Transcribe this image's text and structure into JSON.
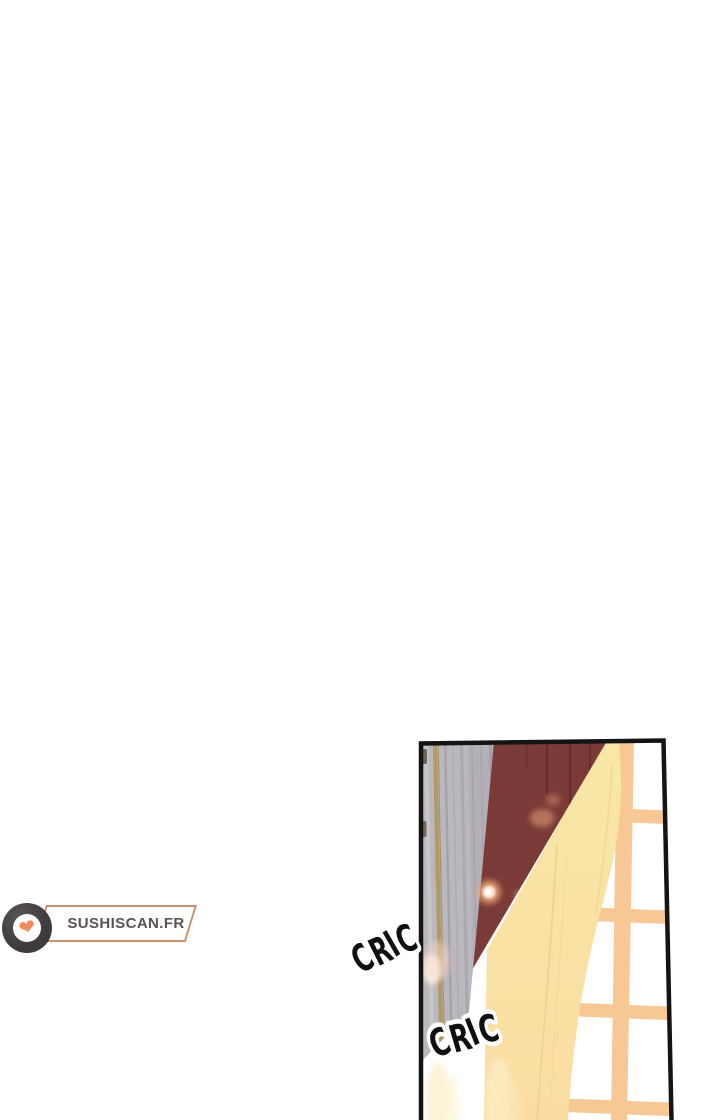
{
  "page": {
    "background_color": "#ffffff"
  },
  "watermark": {
    "site_name": "SUSHISCAN.FR",
    "heart_icon": "❤",
    "text_color": "#5c5250",
    "box_border_color": "#c9906c",
    "ring_color": "#3e3a3d",
    "heart_color": "#ef8b5c"
  },
  "panel": {
    "border_color": "#141414",
    "colors": {
      "wall_gray": "#bbb7be",
      "wall_gold_line": "#b29a5f",
      "curtain_maroon": "#7a3b38",
      "curtain_yellow_top": "#f8e7a6",
      "curtain_yellow_bottom": "#fadca2",
      "window_frame": "#f7c795",
      "window_pane": "#ffffff"
    },
    "sfx": [
      {
        "text": "CRIC"
      },
      {
        "text": "CRIC"
      }
    ]
  }
}
